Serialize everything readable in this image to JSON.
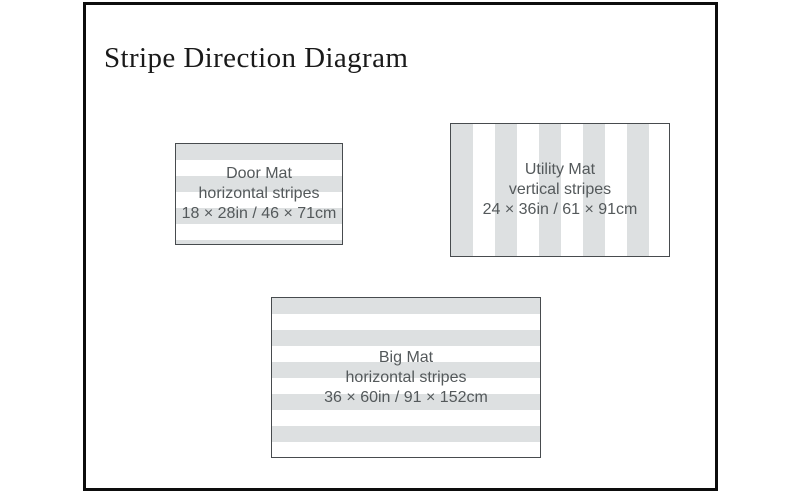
{
  "diagram": {
    "title": "Stripe Direction Diagram",
    "mats": [
      {
        "name": "Door Mat",
        "stripe_direction": "horizontal stripes",
        "size": "18 × 28in / 46 × 71cm",
        "orientation": "horizontal"
      },
      {
        "name": "Utility Mat",
        "stripe_direction": "vertical stripes",
        "size": "24 × 36in / 61 × 91cm",
        "orientation": "vertical"
      },
      {
        "name": "Big Mat",
        "stripe_direction": "horizontal stripes",
        "size": "36 × 60in / 91 × 152cm",
        "orientation": "horizontal"
      }
    ],
    "colors": {
      "stripe_gray": "#dde0e1",
      "stripe_white": "#ffffff",
      "mat_border": "#474b4e",
      "frame_border": "#0d0d0d",
      "label_text": "#54595b",
      "title_text": "#1a1a1a"
    }
  }
}
